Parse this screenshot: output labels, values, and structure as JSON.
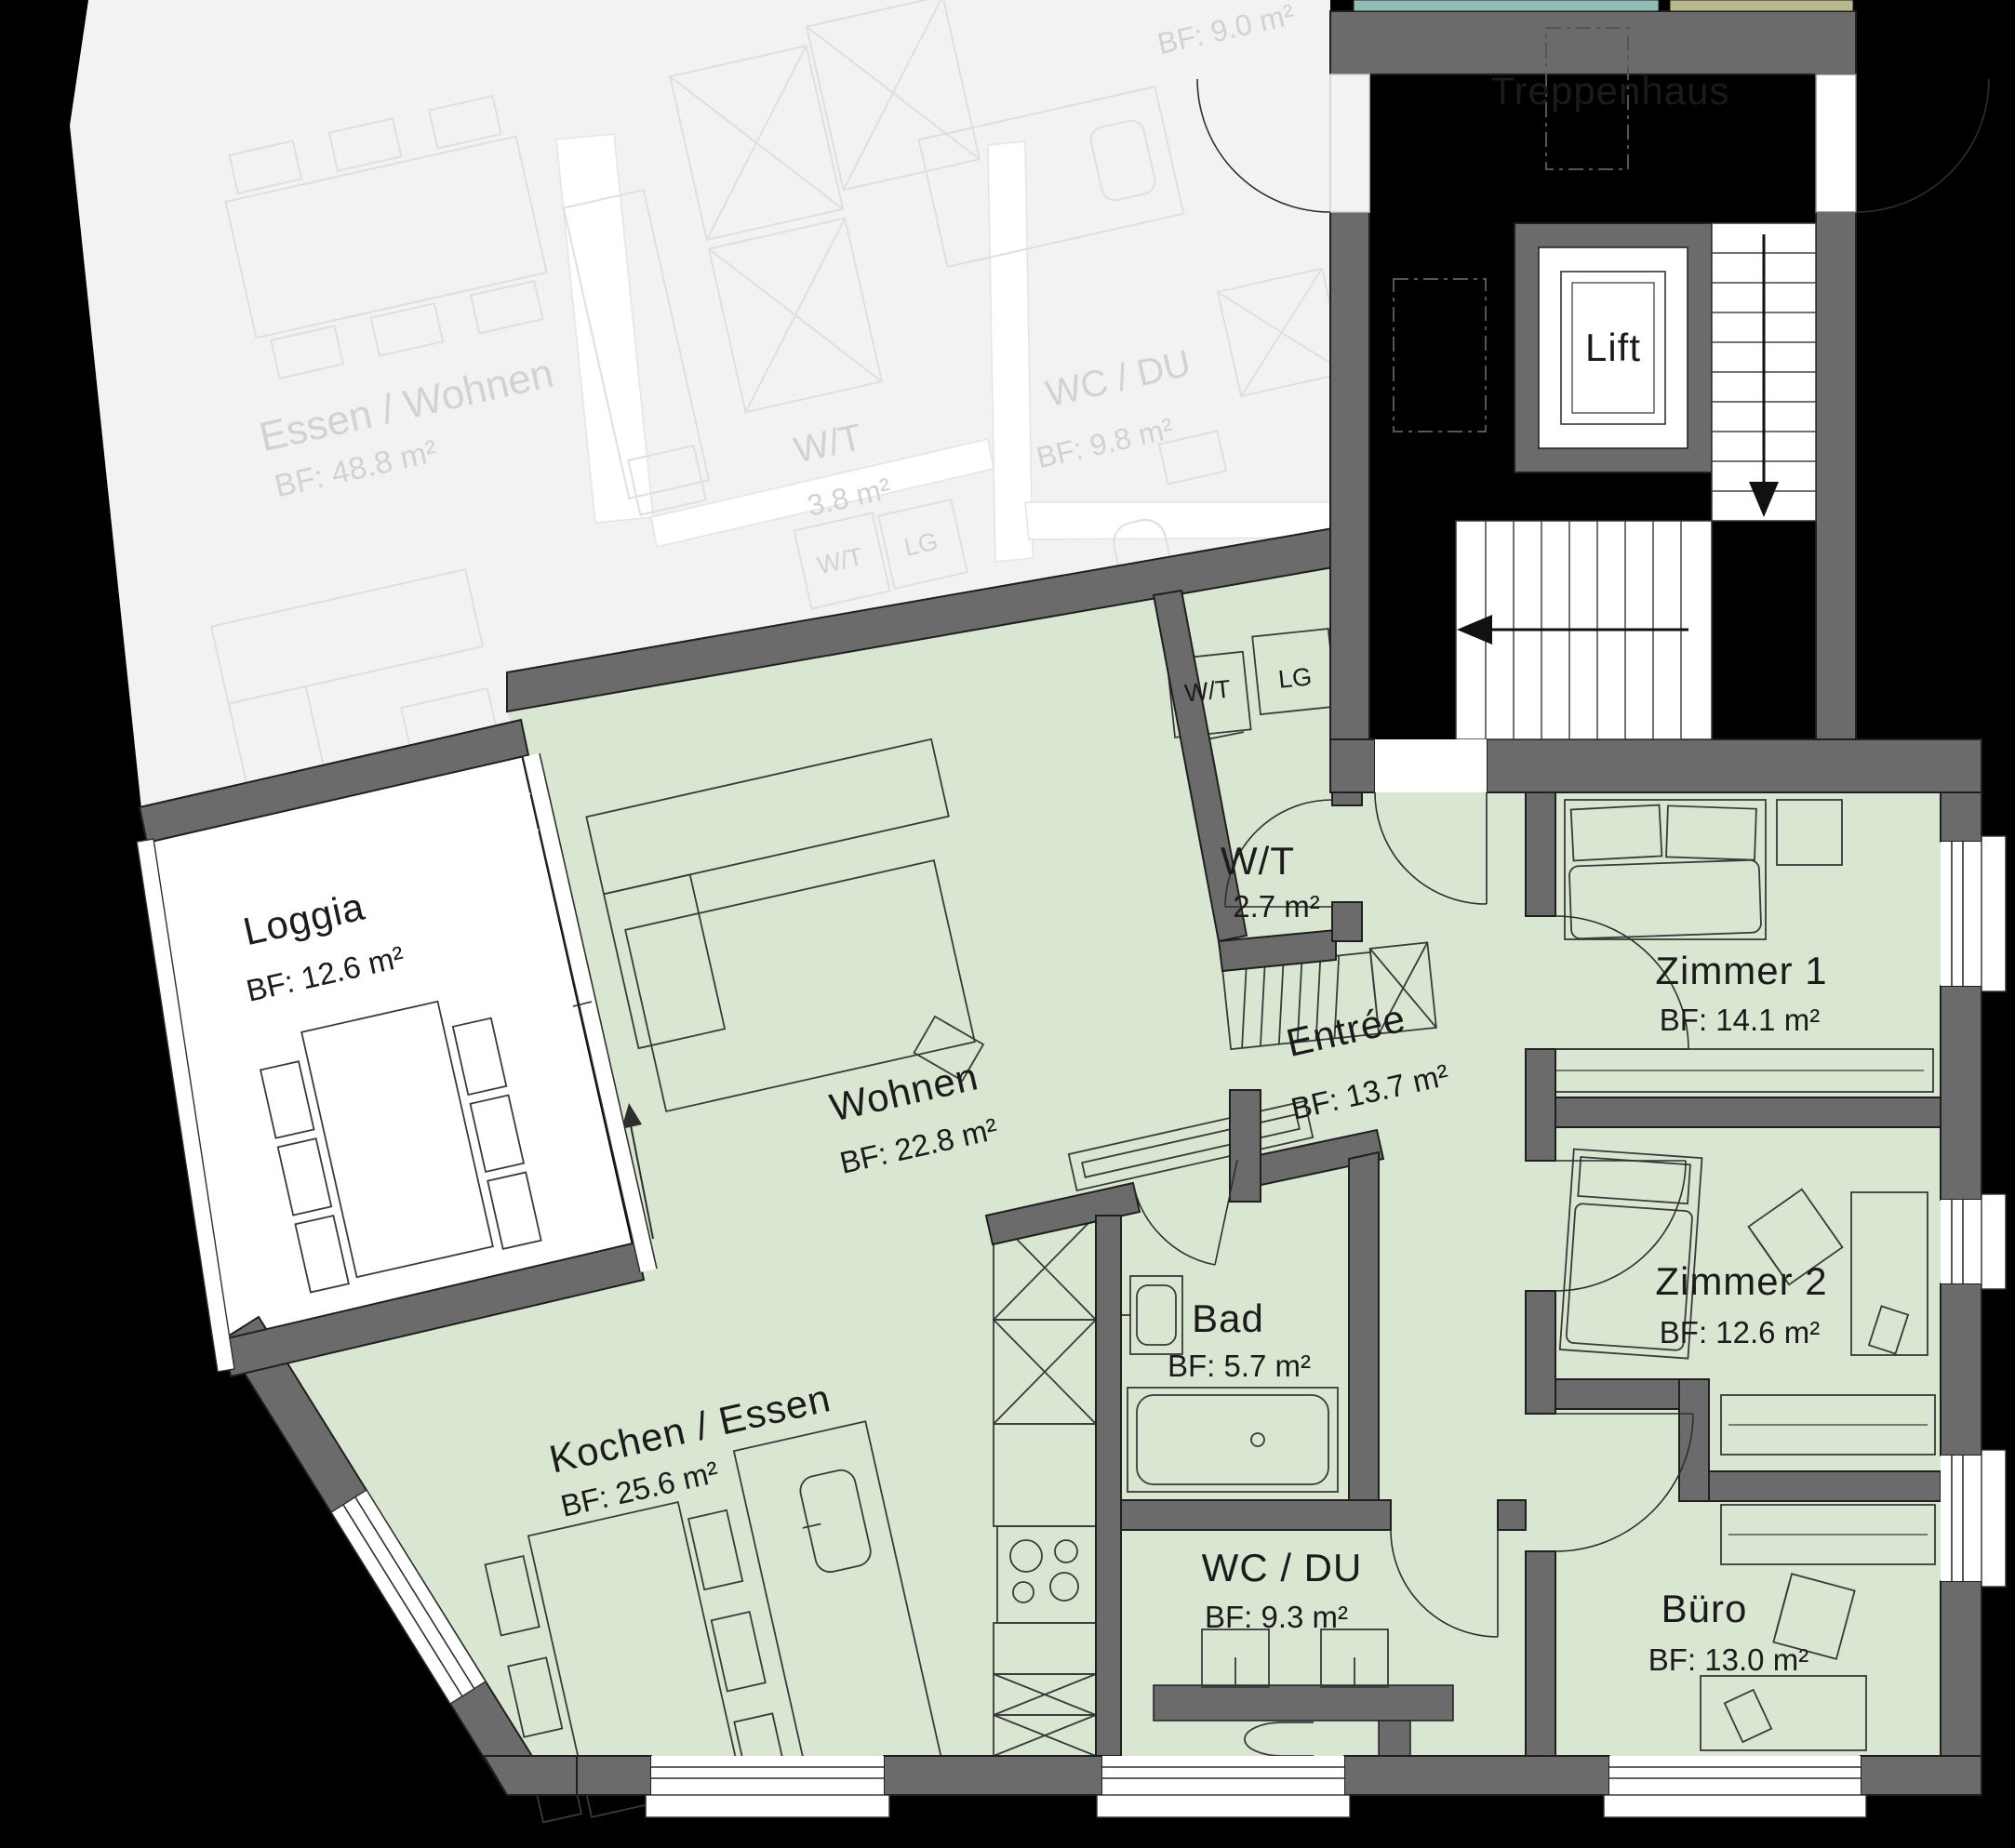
{
  "floorplan": {
    "unit": {
      "rooms": {
        "loggia": {
          "name": "Loggia",
          "area": "BF: 12.6 m²"
        },
        "wohnen": {
          "name": "Wohnen",
          "area": "BF: 22.8 m²"
        },
        "kochen_essen": {
          "name": "Kochen / Essen",
          "area": "BF: 25.6 m²"
        },
        "wt": {
          "name": "W/T",
          "area": "2.7 m²"
        },
        "entree": {
          "name": "Entrée",
          "area": "BF: 13.7 m²"
        },
        "zimmer1": {
          "name": "Zimmer 1",
          "area": "BF: 14.1 m²"
        },
        "zimmer2": {
          "name": "Zimmer 2",
          "area": "BF: 12.6 m²"
        },
        "bad": {
          "name": "Bad",
          "area": "BF: 5.7 m²"
        },
        "wc_du": {
          "name": "WC / DU",
          "area": "BF: 9.3 m²"
        },
        "buero": {
          "name": "Büro",
          "area": "BF: 13.0 m²"
        }
      },
      "appliances": {
        "washer_dryer": "W/T",
        "cabinet": "LG"
      }
    },
    "stairwell": {
      "name": "Treppenhaus",
      "lift": "Lift"
    },
    "neighbor_unit": {
      "rooms": {
        "essen_wohnen": {
          "name": "Essen / Wohnen",
          "area": "BF: 48.8 m²"
        },
        "wt": {
          "name": "W/T",
          "area": "3.8 m²"
        },
        "wc_du": {
          "name": "WC / DU",
          "area": "BF: 9.8 m²"
        }
      },
      "partial_room_area": "BF: 9.0 m²",
      "appliances": {
        "washer_dryer": "W/T",
        "cabinet": "LG"
      }
    },
    "colors": {
      "floor_highlight": "#d9e6d2",
      "walls": "#6b6b6b",
      "stairwell_floor": "#ffffff",
      "neighbor_floor": "#f2f2f2",
      "strip_teal": "#8fbcb4",
      "strip_olive": "#b8b98e",
      "background": "#000000"
    }
  }
}
